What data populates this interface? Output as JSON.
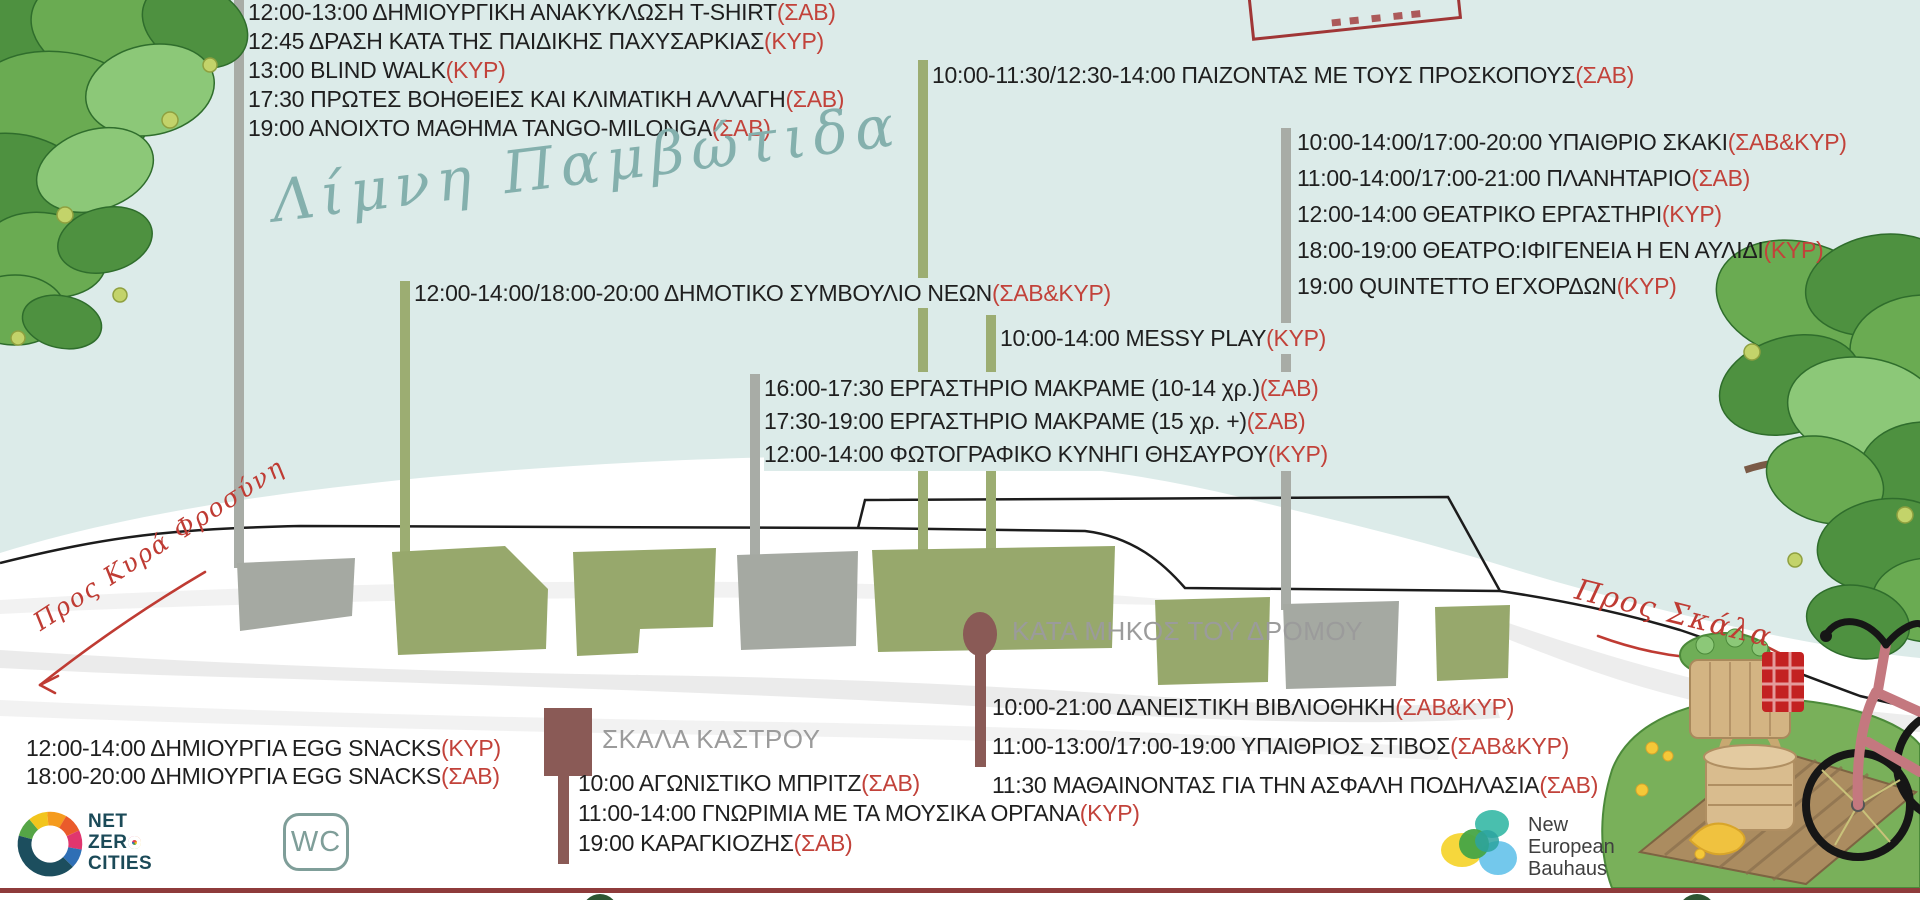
{
  "labels": {
    "lake": "Λίμνη Παμβώτιδα",
    "along_road": "ΚΑΤΑ ΜΗΚΟΣ ΤΟΥ ΔΡΟΜΟΥ",
    "kastro_stairs": "ΣΚΑΛΑ ΚΑΣΤΡΟΥ",
    "to_kyra_frosini": "Προς Κυρά Φροσύνη",
    "to_skala": "Προς Σκάλα",
    "wc": "WC"
  },
  "blocks": {
    "top_left": {
      "events": [
        {
          "text": "12:00-13:00 ΔΗΜΙΟΥΡΓΙΚΗ ΑΝΑΚΥΚΛΩΣΗ T-SHIRT",
          "tag": "(ΣΑΒ)"
        },
        {
          "text": "12:45 ΔΡΑΣΗ ΚΑΤΑ ΤΗΣ ΠΑΙΔΙΚΗΣ ΠΑΧΥΣΑΡΚΙΑΣ",
          "tag": "(ΚΥΡ)"
        },
        {
          "text": "13:00 BLIND WALK",
          "tag": "(ΚΥΡ)"
        },
        {
          "text": "17:30 ΠΡΩΤΕΣ ΒΟΗΘΕΙΕΣ ΚΑΙ ΚΛΙΜΑΤΙΚΗ ΑΛΛΑΓΗ",
          "tag": "(ΣΑΒ)"
        },
        {
          "text": "19:00 ΑΝΟΙΧΤΟ ΜΑΘΗΜΑ TANGO-MILONGA",
          "tag": "(ΣΑΒ)"
        }
      ]
    },
    "scouts": {
      "events": [
        {
          "text": "10:00-11:30/12:30-14:00 ΠΑΙΖΟΝΤΑΣ ΜΕ ΤΟΥΣ ΠΡΟΣΚΟΠΟΥΣ",
          "tag": "(ΣΑΒ)"
        }
      ]
    },
    "right": {
      "events": [
        {
          "text": "10:00-14:00/17:00-20:00 ΥΠΑΙΘΡΙΟ ΣΚΑΚΙ",
          "tag": "(ΣΑΒ&ΚΥΡ)"
        },
        {
          "text": "11:00-14:00/17:00-21:00 ΠΛΑΝΗΤΑΡΙΟ",
          "tag": "(ΣΑΒ)"
        },
        {
          "text": "12:00-14:00 ΘΕΑΤΡΙΚΟ ΕΡΓΑΣΤΗΡΙ",
          "tag": "(ΚΥΡ)"
        },
        {
          "text": "18:00-19:00 ΘΕΑΤΡΟ:ΙΦΙΓΕΝΕΙΑ Η ΕΝ ΑΥΛΙΔΙ",
          "tag": "(ΚΥΡ)"
        },
        {
          "text": "19:00 QUINTETTO ΕΓΧΟΡΔΩΝ",
          "tag": "(ΚΥΡ)"
        }
      ]
    },
    "youth_council": {
      "events": [
        {
          "text": "12:00-14:00/18:00-20:00 ΔΗΜΟΤΙΚΟ ΣΥΜΒΟΥΛΙΟ ΝΕΩΝ",
          "tag": "(ΣΑΒ&ΚΥΡ)"
        }
      ]
    },
    "messy": {
      "events": [
        {
          "text": "10:00-14:00 MESSY PLAY",
          "tag": "(ΚΥΡ)"
        }
      ]
    },
    "macrame": {
      "events": [
        {
          "text": "16:00-17:30 ΕΡΓΑΣΤΗΡΙΟ ΜΑΚΡΑΜΕ (10-14 χρ.)",
          "tag": "(ΣΑΒ)"
        },
        {
          "text": "17:30-19:00 ΕΡΓΑΣΤΗΡΙΟ ΜΑΚΡΑΜΕ (15 χρ. +)",
          "tag": "(ΣΑΒ)"
        },
        {
          "text": "12:00-14:00 ΦΩΤΟΓΡΑΦΙΚΟ ΚΥΝΗΓΙ ΘΗΣΑΥΡΟΥ",
          "tag": "(ΚΥΡ)"
        }
      ]
    },
    "egg_snacks": {
      "events": [
        {
          "text": "12:00-14:00 ΔΗΜΙΟΥΡΓΙΑ EGG SNACKS",
          "tag": "(ΚΥΡ)"
        },
        {
          "text": "18:00-20:00 ΔΗΜΙΟΥΡΓΙΑ EGG SNACKS",
          "tag": "(ΣΑΒ)"
        }
      ]
    },
    "kastro": {
      "events": [
        {
          "text": "10:00 ΑΓΩΝΙΣΤΙΚΟ ΜΠΡΙΤΖ",
          "tag": "(ΣΑΒ)"
        },
        {
          "text": "11:00-14:00 ΓΝΩΡΙΜΙΑ ΜΕ ΤΑ ΜΟΥΣΙΚΑ ΟΡΓΑΝΑ",
          "tag": "(ΚΥΡ)"
        },
        {
          "text": "19:00 ΚΑΡΑΓΚΙΟΖΗΣ",
          "tag": "(ΣΑΒ)"
        }
      ]
    },
    "along_road": {
      "events": [
        {
          "text": "10:00-21:00 ΔΑΝΕΙΣΤΙΚΗ ΒΙΒΛΙΟΘΗΚΗ",
          "tag": "(ΣΑΒ&ΚΥΡ)"
        },
        {
          "text": "11:00-13:00/17:00-19:00 ΥΠΑΙΘΡΙΟΣ ΣΤΙΒΟΣ",
          "tag": "(ΣΑΒ&ΚΥΡ)"
        },
        {
          "text": "11:30 ΜΑΘΑΙΝΟΝΤΑΣ ΓΙΑ ΤΗΝ ΑΣΦΑΛΗ ΠΟΔΗΛΑΣΙΑ",
          "tag": "(ΣΑΒ)"
        }
      ]
    }
  },
  "logos": {
    "netzero": {
      "line1": "NET",
      "line2_pre": "ZER",
      "line2_o": "O",
      "line3": "CITIES"
    },
    "neb": {
      "line1": "New",
      "line2": "European",
      "line3": "Bauhaus"
    }
  },
  "colors": {
    "lake": "#dcebe9",
    "red": "#c2423a",
    "bargreen": "#9cad72",
    "plotgreen": "#97a86c",
    "bargray": "#a8aca6",
    "plotgray": "#a5a9a2",
    "brown": "#8a5a56",
    "graytext": "#9b9b9b",
    "teal": "#84b0ad",
    "navy": "#1b4a58",
    "wcteal": "#7f9e99",
    "borderred": "#8e3b3b"
  }
}
